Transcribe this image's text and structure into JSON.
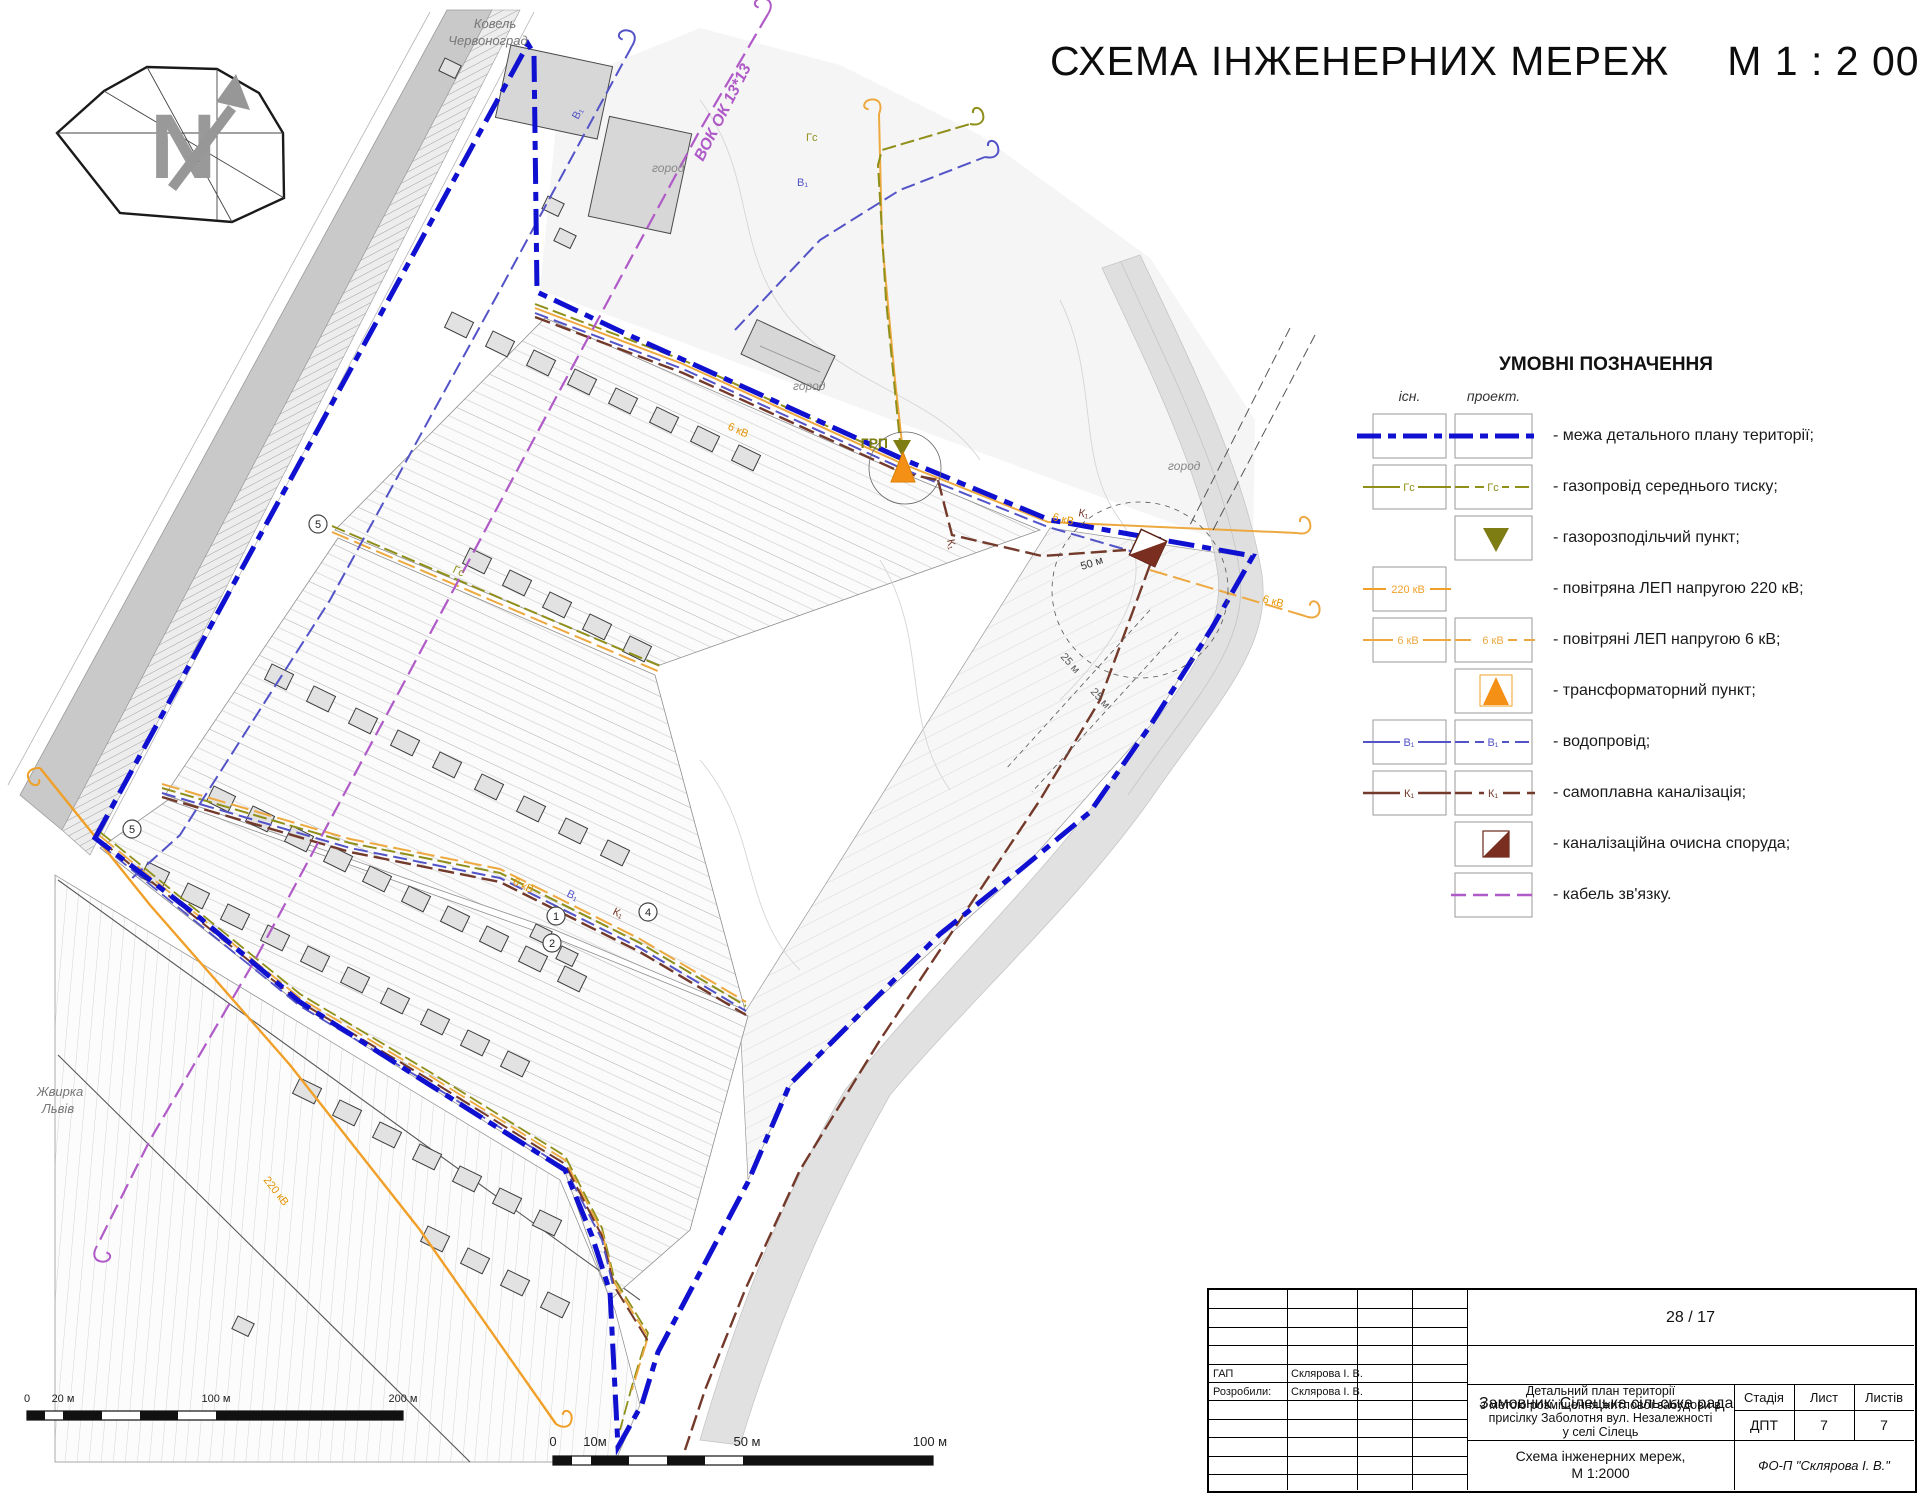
{
  "page": {
    "title": "СХЕМА ІНЖЕНЕРНИХ МЕРЕЖ",
    "scale": "М 1 : 2 000"
  },
  "legend": {
    "title": "УМОВНІ ПОЗНАЧЕННЯ",
    "col_existing": "існ.",
    "col_projected": "проект.",
    "items": [
      {
        "label": "- межа детального плану території;"
      },
      {
        "label": "- газопровід середнього тиску;",
        "tag": "Гс"
      },
      {
        "label": "- газорозподільчий пункт;"
      },
      {
        "label": "- повітряна ЛЕП напругою 220 кВ;",
        "tag": "220 кВ"
      },
      {
        "label": "- повітряні ЛЕП напругою 6 кВ;",
        "tag": "6 кВ"
      },
      {
        "label": "- трансформаторний пункт;"
      },
      {
        "label": "- водопровід;",
        "tag": "В₁"
      },
      {
        "label": "- самоплавна каналізація;",
        "tag": "К₁"
      },
      {
        "label": "- каналізаційна очисна споруда;"
      },
      {
        "label": "- кабель зв'язку."
      }
    ]
  },
  "map": {
    "north": "N",
    "road_dest_top1": "Ковель",
    "road_dest_top2": "Червоноград",
    "cable_label": "ВОК ОК 13*13",
    "road_dest_bottom1": "Жвирка",
    "road_dest_bottom2": "Львів",
    "grp": "ГРП",
    "garden": "город",
    "kv6": "6 кВ",
    "kv220": "220 кВ",
    "gas": "Гс",
    "water": "В₁",
    "sewer": "К₁",
    "r50": "50 м",
    "r25": "25 м",
    "num1": "1",
    "num2": "2",
    "num4": "4",
    "num5": "5"
  },
  "scalebar_small": {
    "t0": "0",
    "t1": "20 м",
    "t2": "100 м",
    "t3": "200 м"
  },
  "scalebar_large": {
    "t0": "0",
    "t1": "10м",
    "t2": "50 м",
    "t3": "100 м"
  },
  "titleblock": {
    "doc_number": "28 / 17",
    "client": "Замовник: Сілецька сільська рада",
    "project_lines": [
      "Детальний план території",
      "з метою розміщення житлової забудови в",
      "присілку Заболотня вул. Незалежності",
      "у селі Сілець"
    ],
    "stage_label": "Стадія",
    "sheet_label": "Лист",
    "sheets_label": "Листів",
    "stage": "ДПТ",
    "sheet": "7",
    "sheets": "7",
    "doc_title_line1": "Схема інженерних мереж,",
    "doc_title_line2": "М 1:2000",
    "firm": "ФО-П \"Склярова І. В.\"",
    "roles": [
      {
        "role": "ГАП",
        "name": "Склярова І. В."
      },
      {
        "role": "Розробили:",
        "name": "Склярова І. В."
      }
    ]
  },
  "colors": {
    "boundary": "#1010d0",
    "water": "#5353c8",
    "sewer": "#73392a",
    "gas": "#8f8f1a",
    "power220": "#f0a028",
    "power6": "#eda93f",
    "cable": "#b05ac8",
    "transformer": "#f59016",
    "grp_point": "#7d7d14"
  }
}
